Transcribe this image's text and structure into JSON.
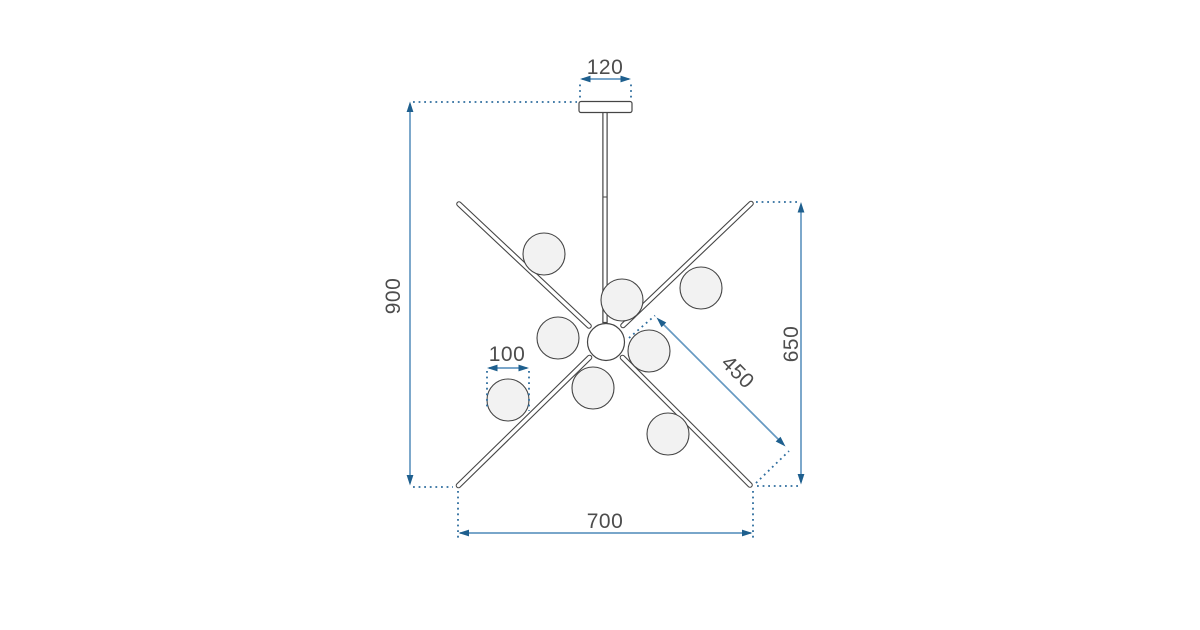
{
  "drawing": {
    "subject": "technical-dimension-drawing-of-8-globe-pendant-chandelier",
    "globe_count": 8,
    "dimensions": {
      "canopy_width": "120",
      "overall_height": "900",
      "globe_diameter": "100",
      "arm_length": "450",
      "fixture_height": "650",
      "fixture_width": "700"
    },
    "colors": {
      "background": "#ffffff",
      "line_art": "#454545",
      "globe_fill": "#f2f2f2",
      "dimension_line": "#6699c2",
      "dimension_arrow": "#1e5f8e",
      "dimension_dots": "#2e6d9e",
      "label_text": "#4d4d4d"
    }
  }
}
